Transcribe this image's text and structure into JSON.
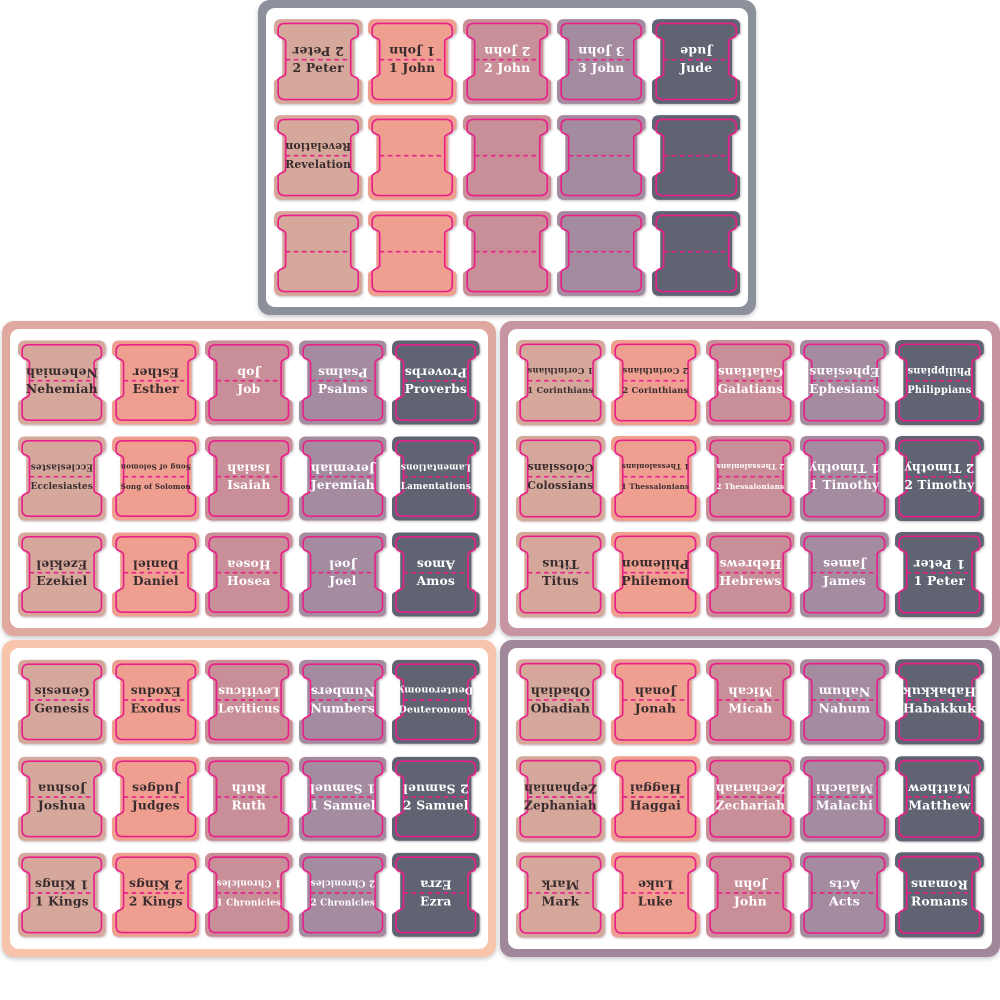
{
  "colors": {
    "page_background": "#ffffff",
    "sheet_background": "#ffffff",
    "sticker_outline": "#e8218a",
    "fold_line": "#e8218a",
    "text_dark": "#392c2e",
    "text_light": "#ffffff",
    "column_fills": [
      "#d6a89b",
      "#ee9f90",
      "#c98f99",
      "#a58ba0",
      "#5f6372"
    ],
    "column_text_style": [
      "dark",
      "dark",
      "light",
      "light",
      "light"
    ]
  },
  "panels": [
    {
      "name": "sheet-top-center",
      "position": "top-center",
      "frame_color": "#8b909b",
      "rows": [
        [
          "2 Peter",
          "1 John",
          "2 John",
          "3 John",
          "Jude"
        ],
        [
          "Revelation",
          "",
          "",
          "",
          ""
        ],
        [
          "",
          "",
          "",
          "",
          ""
        ]
      ]
    },
    {
      "name": "sheet-middle-left",
      "position": "middle-left",
      "frame_color": "#dfa9a0",
      "rows": [
        [
          "Nehemiah",
          "Esther",
          "Job",
          "Psalms",
          "Proverbs"
        ],
        [
          "Ecclesiastes",
          "Song of Solomon",
          "Isaiah",
          "Jeremiah",
          "Lamentations"
        ],
        [
          "Ezekiel",
          "Daniel",
          "Hosea",
          "Joel",
          "Amos"
        ]
      ]
    },
    {
      "name": "sheet-middle-right",
      "position": "middle-right",
      "frame_color": "#c794a2",
      "rows": [
        [
          "1 Corinthians",
          "2 Corinthians",
          "Galatians",
          "Ephesians",
          "Philippians"
        ],
        [
          "Colossians",
          "1 Thessalonians",
          "2 Thessalonians",
          "1 Timothy",
          "2 Timothy"
        ],
        [
          "Titus",
          "Philemon",
          "Hebrews",
          "James",
          "1 Peter"
        ]
      ]
    },
    {
      "name": "sheet-bottom-left",
      "position": "bottom-left",
      "frame_color": "#f9c4ac",
      "rows": [
        [
          "Genesis",
          "Exodus",
          "Leviticus",
          "Numbers",
          "Deuteronomy"
        ],
        [
          "Joshua",
          "Judges",
          "Ruth",
          "1 Samuel",
          "2 Samuel"
        ],
        [
          "1 Kings",
          "2 Kings",
          "1 Chronicles",
          "2 Chronicles",
          "Ezra"
        ]
      ]
    },
    {
      "name": "sheet-bottom-right",
      "position": "bottom-right",
      "frame_color": "#a1879a",
      "rows": [
        [
          "Obadiah",
          "Jonah",
          "Micah",
          "Nahum",
          "Habakkuk"
        ],
        [
          "Zephaniah",
          "Haggai",
          "Zechariah",
          "Malachi",
          "Matthew"
        ],
        [
          "Mark",
          "Luke",
          "John",
          "Acts",
          "Romans"
        ]
      ]
    }
  ]
}
